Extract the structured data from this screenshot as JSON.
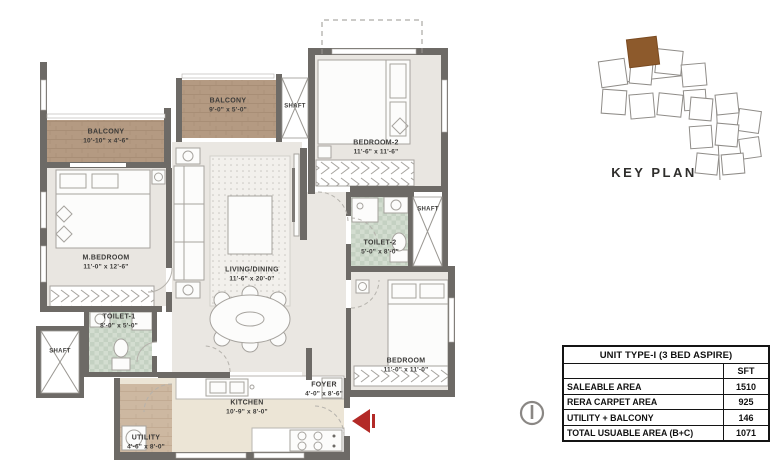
{
  "plan": {
    "rooms": {
      "balcony1": {
        "name": "BALCONY",
        "dims": "10'-10\" x 4'-6\""
      },
      "balcony2": {
        "name": "BALCONY",
        "dims": "9'-0\" x 5'-0\""
      },
      "shaft_top": {
        "name": "SHAFT"
      },
      "bedroom2": {
        "name": "BEDROOM-2",
        "dims": "11'-6\" x 11'-6\""
      },
      "m_bedroom": {
        "name": "M.BEDROOM",
        "dims": "11'-0\" x 12'-6\""
      },
      "living_dining": {
        "name": "LIVING/DINING",
        "dims": "11'-6\" x 20'-0\""
      },
      "toilet2": {
        "name": "TOILET-2",
        "dims": "5'-0\" x 8'-0\""
      },
      "shaft_right": {
        "name": "SHAFT"
      },
      "toilet1": {
        "name": "TOILET-1",
        "dims": "8'-0\" x 5'-0\""
      },
      "shaft_left": {
        "name": "SHAFT"
      },
      "bedroom": {
        "name": "BEDROOM",
        "dims": "11'-0\" x 11'-0\""
      },
      "foyer": {
        "name": "FOYER",
        "dims": "4'-0\" x 8'-6\""
      },
      "kitchen": {
        "name": "KITCHEN",
        "dims": "10'-9\" x 8'-0\""
      },
      "utility": {
        "name": "UTILITY",
        "dims": "4'-6\" x 8'-0\""
      }
    }
  },
  "key_plan": {
    "label": "KEY PLAN"
  },
  "area_table": {
    "title": "UNIT TYPE-I (3 BED ASPIRE)",
    "unit_header": "SFT",
    "rows": [
      {
        "label": "SALEABLE AREA",
        "value": "1510"
      },
      {
        "label": "RERA CARPET AREA",
        "value": "925"
      },
      {
        "label": "UTILITY + BALCONY",
        "value": "146"
      },
      {
        "label": "TOTAL USUABLE AREA (B+C)",
        "value": "1071"
      }
    ]
  },
  "colors": {
    "wall": "#6d6a66",
    "floor": "#e9e6e1",
    "wood": "#b49a82",
    "utility_wood": "#cdb8a1",
    "tile": "#ccd7ca",
    "entry_arrow_red": "#b32a27",
    "keyplan_highlight": "#8d5a2c"
  }
}
